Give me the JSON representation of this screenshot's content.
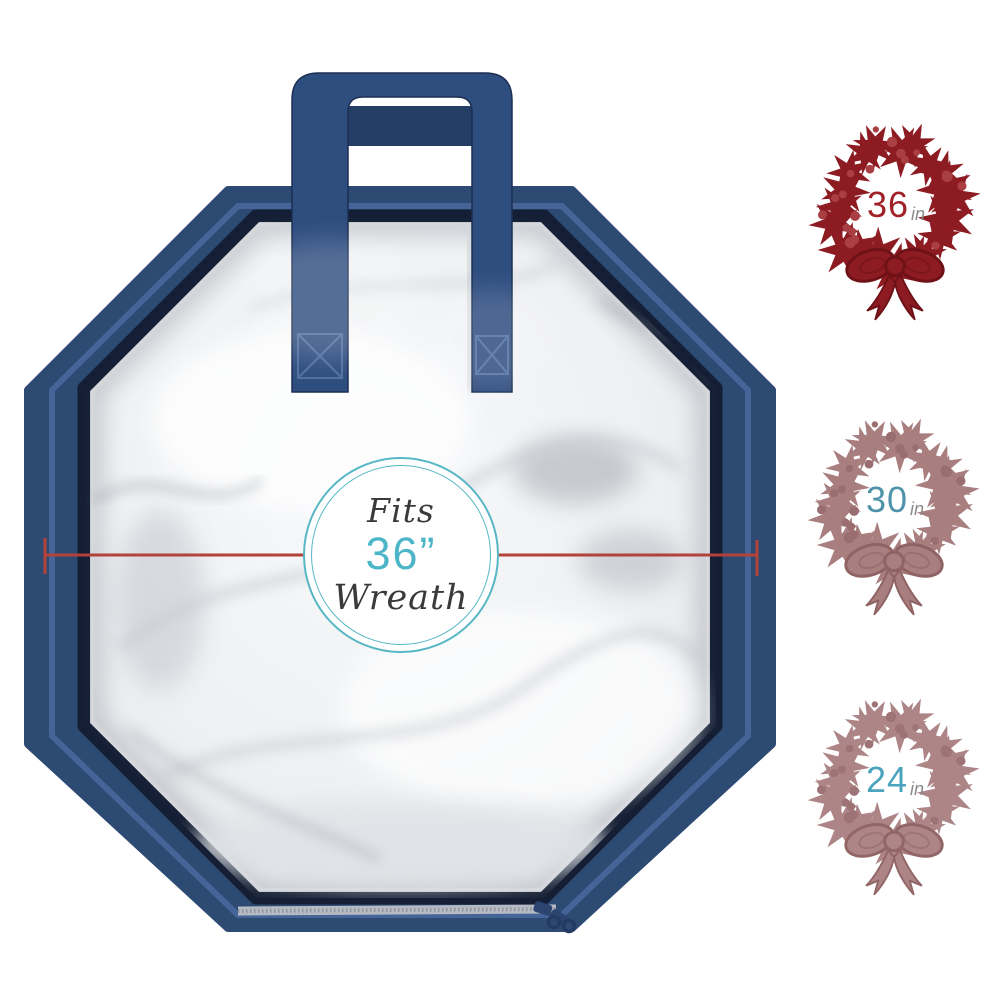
{
  "image_type": "wreath-storage-bag product infographic",
  "bag": {
    "center_badge": {
      "line1": "Fits",
      "size": "36”",
      "line2": "Wreath"
    },
    "colors": {
      "navy": "#2d4a73",
      "navy_dark": "#1d3050",
      "handle": "#2f4e80",
      "handle_dark": "#253e66",
      "zipper_stripe": "#47669b",
      "zipper_tape": "#b6bac2"
    }
  },
  "badge_colors": {
    "ring": "#57b7c5",
    "size_text": "#4cb6c8",
    "script_text": "#3a3a3a"
  },
  "dimension_line": {
    "color": "#b2423a"
  },
  "size_options": [
    {
      "size": "36",
      "unit": "in",
      "wreath_color": "#8d1b22",
      "berry_color": "#a93e43",
      "outline_color": "#6e1217",
      "number_color": "#a02127",
      "unit_color": "#8b8b8b"
    },
    {
      "size": "30",
      "unit": "in",
      "wreath_color": "#a87e7f",
      "berry_color": "#9a6e70",
      "outline_color": "#8f6263",
      "number_color": "#4f93aa",
      "unit_color": "#8b8b8b"
    },
    {
      "size": "24",
      "unit": "in",
      "wreath_color": "#ad8586",
      "berry_color": "#9e7375",
      "outline_color": "#926667",
      "number_color": "#4ba4bd",
      "unit_color": "#8b8b8b"
    }
  ]
}
